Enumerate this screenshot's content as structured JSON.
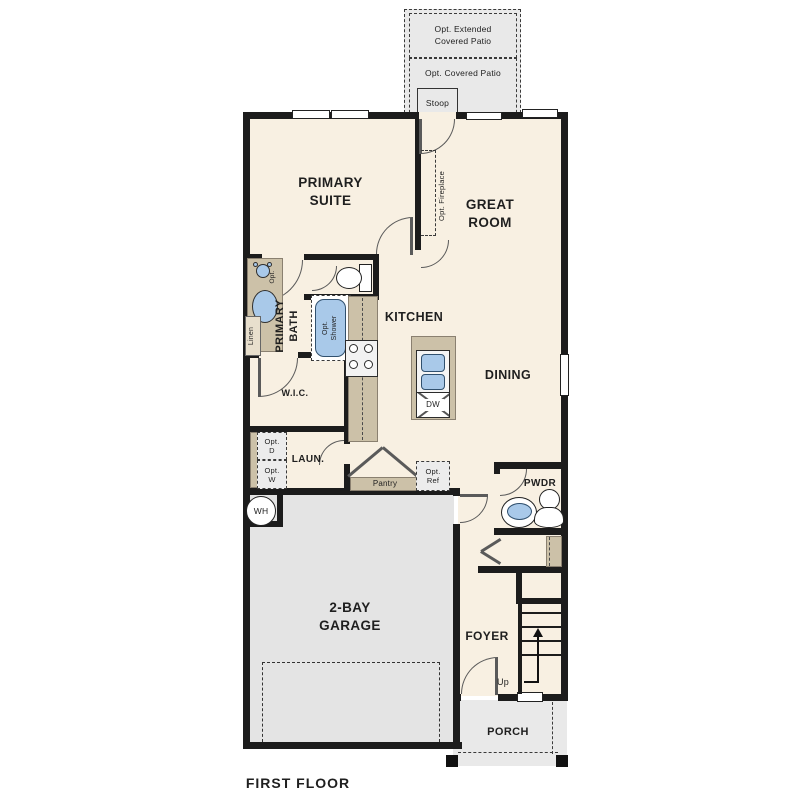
{
  "title": "FIRST FLOOR",
  "colors": {
    "wall": "#1c1c1c",
    "floor": "#f8f0e2",
    "garage": "#e4e4e4",
    "patio": "#e9e9e9",
    "counter": "#ccc1a8",
    "fixture": "#a9c9e9",
    "line": "#5a5a5a"
  },
  "outdoor": {
    "extended_patio": "Opt. Extended\nCovered Patio",
    "covered_patio": "Opt. Covered Patio",
    "stoop": "Stoop",
    "porch": "PORCH"
  },
  "rooms": {
    "primary_suite": "PRIMARY\nSUITE",
    "great_room": "GREAT\nROOM",
    "primary_bath": "PRIMARY\nBATH",
    "kitchen": "KITCHEN",
    "wic": "W.I.C.",
    "dining": "DINING",
    "laundry": "LAUN.",
    "pwdr": "PWDR",
    "garage": "2-BAY\nGARAGE",
    "foyer": "FOYER"
  },
  "annotations": {
    "opt_fireplace": "Opt. Fireplace",
    "opt_shower": "Opt.\nShower",
    "opt_sink": "Opt.",
    "linen": "Linen",
    "opt_dryer": "Opt.\nD",
    "opt_washer": "Opt.\nW",
    "pantry": "Pantry",
    "opt_ref": "Opt.\nRef",
    "dishwasher": "DW",
    "water_heater": "WH",
    "stairs_up": "Up"
  }
}
